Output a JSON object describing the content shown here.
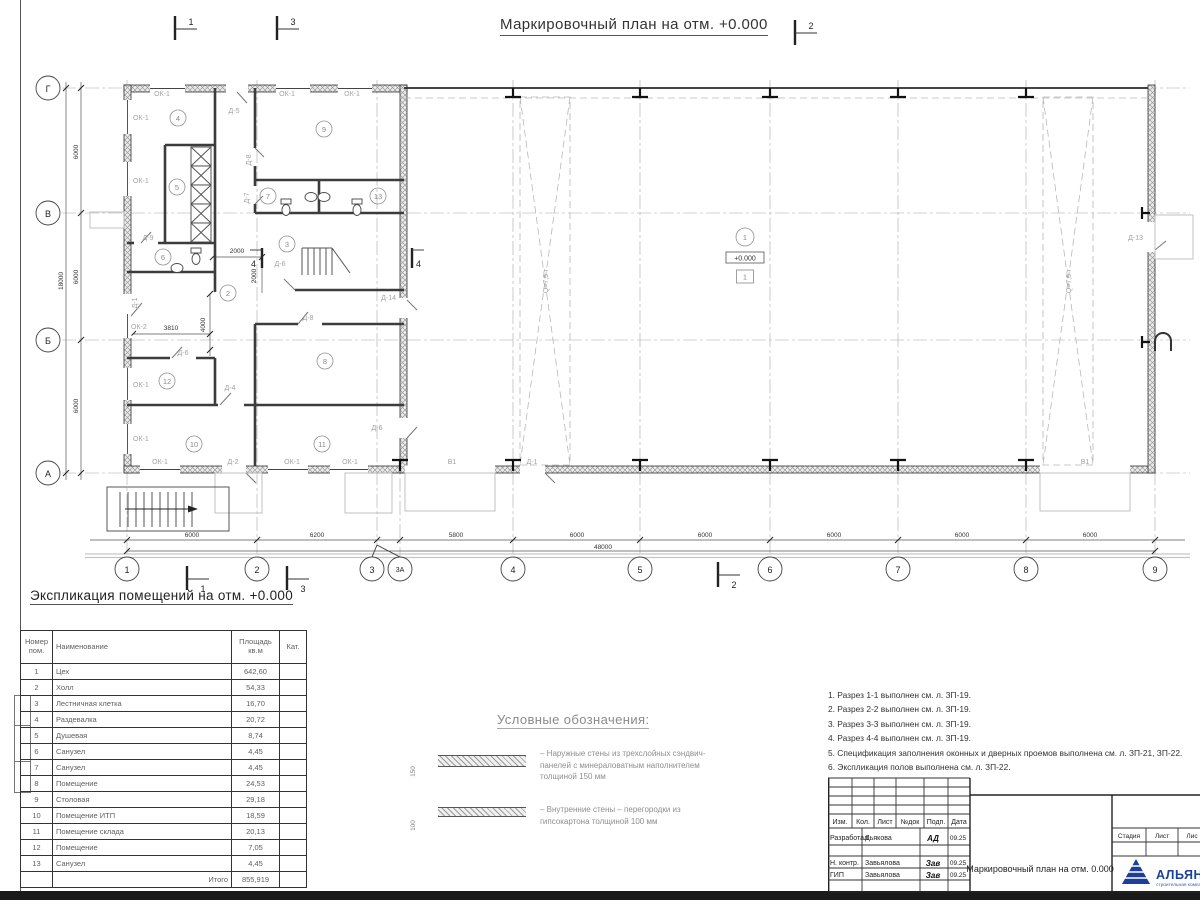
{
  "sheet": {
    "plan_title": "Маркировочный план на отм. +0.000",
    "expl_title": "Экспликация помещений на отм. +0.000"
  },
  "plan": {
    "axes_rows": [
      "Г",
      "В",
      "Б",
      "А"
    ],
    "axes_cols": [
      "1",
      "2",
      "3",
      "3А",
      "4",
      "5",
      "6",
      "7",
      "8",
      "9"
    ],
    "dims": {
      "d6000": "6000",
      "d6200": "6200",
      "d5800": "5800",
      "d48000": "48000",
      "d18000": "18000",
      "d2000": "2000",
      "d4000": "4000",
      "d3810": "3810"
    },
    "rooms": [
      "1",
      "2",
      "3",
      "4",
      "5",
      "6",
      "7",
      "8",
      "9",
      "10",
      "11",
      "12",
      "13"
    ],
    "labels": {
      "ok1": "ОК-1",
      "ok2": "ОК-2",
      "d1": "Д-1",
      "d2": "Д-2",
      "d4": "Д-4",
      "d5": "Д-5",
      "d6": "Д-6",
      "d7": "Д-7",
      "d8": "Д-8",
      "d9": "Д-9",
      "d13": "Д-13",
      "d14": "Д-14",
      "v1": "В1"
    },
    "sections": {
      "s1": "1",
      "s2": "2",
      "s3": "3",
      "s4": "4"
    },
    "hall": {
      "elevation": "+0.000",
      "level": "1",
      "crane": "Q=7,5 т"
    }
  },
  "explication": {
    "headers": [
      "Номер\nпом.",
      "Наименование",
      "Площадь\nкв.м",
      "Кат."
    ],
    "rows": [
      [
        "1",
        "Цех",
        "642,60"
      ],
      [
        "2",
        "Холл",
        "54,33"
      ],
      [
        "3",
        "Лестничная клетка",
        "16,70"
      ],
      [
        "4",
        "Раздевалка",
        "20,72"
      ],
      [
        "5",
        "Душевая",
        "8,74"
      ],
      [
        "6",
        "Санузел",
        "4,45"
      ],
      [
        "7",
        "Санузел",
        "4,45"
      ],
      [
        "8",
        "Помещение",
        "24,53"
      ],
      [
        "9",
        "Столовая",
        "29,18"
      ],
      [
        "10",
        "Помещение ИТП",
        "18,59"
      ],
      [
        "11",
        "Помещение склада",
        "20,13"
      ],
      [
        "12",
        "Помещение",
        "7,05"
      ],
      [
        "13",
        "Санузел",
        "4,45"
      ]
    ],
    "total_label": "Итого",
    "total_value": "855,919"
  },
  "legend": {
    "heading": "Условные обозначения:",
    "items": [
      {
        "dim": "150",
        "text": "– Наружные стены из трехслойных сэндвич-панелей с минераловатным наполнителем толщиной 150 мм"
      },
      {
        "dim": "100",
        "text": "– Внутренние стены – перегородки из гипсокартона толщиной 100 мм"
      }
    ]
  },
  "notes": [
    "1. Разрез 1-1 выполнен см. л. ЗП-19.",
    "2. Разрез 2-2 выполнен см. л. ЗП-19.",
    "3. Разрез 3-3 выполнен см. л. ЗП-19.",
    "4. Разрез 4-4 выполнен см. л. ЗП-19.",
    "5. Спецификация заполнения оконных и дверных проемов выполнена см. л. ЗП-21, ЗП-22.",
    "6. Экспликация полов выполнена см. л. ЗП-22."
  ],
  "titleblock": {
    "cols": [
      "Изм.",
      "Кол.",
      "Лист",
      "№док",
      "Подп.",
      "Дата"
    ],
    "people": [
      {
        "role": "Разработал",
        "name": "Дьякова",
        "sign": "АД",
        "date": "09.25"
      },
      {
        "role": "Н. контр.",
        "name": "Завьялова",
        "sign": "Зав",
        "date": "09.25"
      },
      {
        "role": "ГИП",
        "name": "Завьялова",
        "sign": "Зав",
        "date": "09.25"
      }
    ],
    "doc_title": "Маркировочный план на отм. 0.000",
    "stage_cols": [
      "Стадия",
      "Лист",
      "Лис"
    ],
    "logo": {
      "name": "АЛЬЯНС",
      "sub": "строительная компания",
      "color": "#1c3f9b"
    }
  }
}
